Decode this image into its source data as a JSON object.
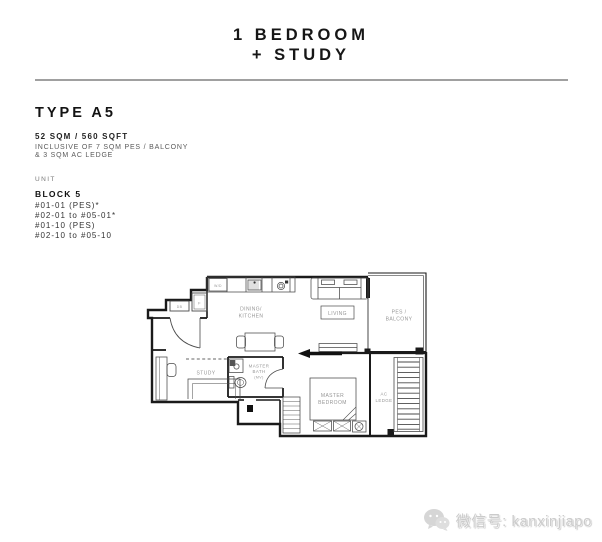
{
  "header": {
    "title_line1": "1 BEDROOM",
    "title_line2": "+ STUDY"
  },
  "info": {
    "type": "TYPE A5",
    "area": "52 SQM / 560 SQFT",
    "inclusive_line1": "INCLUSIVE OF 7 SQM PES / BALCONY",
    "inclusive_line2": "& 3 SQM AC LEDGE",
    "unit_label": "UNIT",
    "block": "BLOCK 5",
    "units": [
      "#01-01 (PES)*",
      "#02-01 to #05-01*",
      "#01-10 (PES)",
      "#02-10 to #05-10"
    ]
  },
  "plan": {
    "rooms": {
      "dining": [
        "DINING/",
        "KITCHEN"
      ],
      "living": "LIVING",
      "balcony": [
        "PES /",
        "BALCONY"
      ],
      "study": "STUDY",
      "bath": [
        "MASTER",
        "BATH",
        "(MV)"
      ],
      "bedroom": [
        "MASTER",
        "BEDROOM"
      ],
      "ledge": [
        "AC",
        "LEDGE"
      ]
    },
    "appliances": {
      "washer": "W/D",
      "db": "DB",
      "fridge": "F"
    }
  },
  "watermark": {
    "text": "微信号: kanxinjiapo"
  },
  "colors": {
    "wall": "#1a1a1a",
    "furniture": "#4a4a4a",
    "room_label": "#969696",
    "divider": "#a0a0a0",
    "watermark": "#cbcbcb"
  }
}
